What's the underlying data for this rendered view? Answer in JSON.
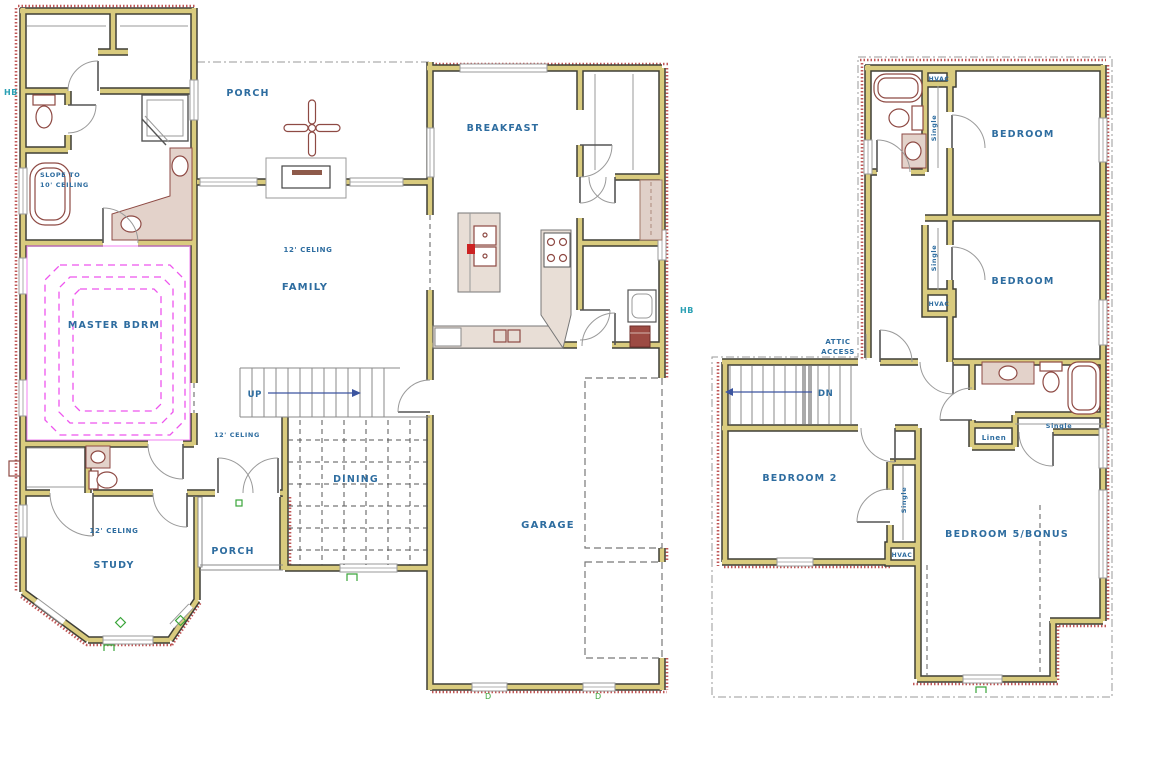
{
  "drawing_title": "Two-story house floor plan",
  "colors": {
    "wall_fill": "#d9cb7e",
    "wall_outline": "#3f3f37",
    "label_blue": "#2e6da0",
    "hose_bib_teal": "#2aa0b4",
    "tray_ceiling_magenta": "#ee55ee",
    "fixture_maroon": "#8e4a44",
    "brick_hatch_red": "#c05858",
    "marker_green": "#3aa53a",
    "stair_arrow_blue": "#3c55a0"
  },
  "floor1": {
    "hb_left": "HB",
    "hb_right": "HB",
    "porch_top": "PORCH",
    "breakfast": "BREAKFAST",
    "slope_line1": "SLOPE TO",
    "slope_line2": "10' CEILING",
    "family_ceiling": "12' CELING",
    "family": "FAMILY",
    "master": "MASTER BDRM",
    "up": "UP",
    "hall_ceiling": "12' CELING",
    "dining": "DINING",
    "study_ceiling": "12' CELING",
    "study": "STUDY",
    "porch_bottom": "PORCH",
    "garage": "GARAGE",
    "marker_d1": "D",
    "marker_d2": "D"
  },
  "floor2": {
    "hvac_top": "HVAC",
    "single_top": "Single",
    "bedroom_top": "BEDROOM",
    "single_mid": "Single",
    "hvac_mid": "HVAC",
    "bedroom_mid": "BEDROOM",
    "attic_line1": "ATTIC",
    "attic_line2": "ACCESS",
    "dn": "DN",
    "bedroom2": "BEDROOM 2",
    "single_b2": "Single",
    "hvac_b2": "HVAC",
    "linen": "Linen",
    "single_bath": "Single",
    "bonus": "BEDROOM 5/BONUS"
  }
}
